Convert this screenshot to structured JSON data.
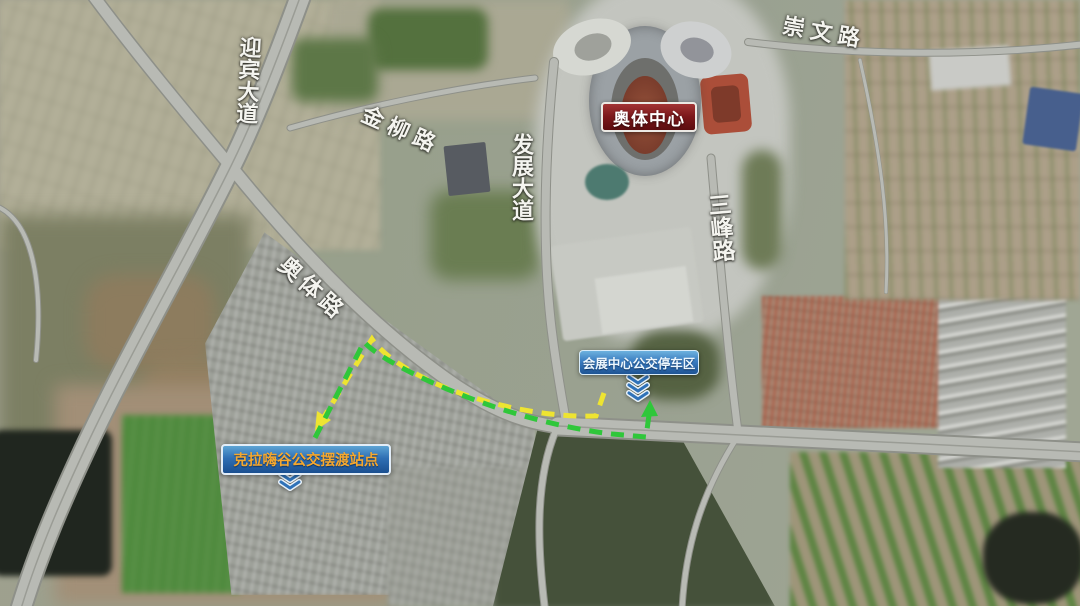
{
  "map": {
    "type": "satellite-map",
    "road_labels": {
      "yingbin_avenue": "迎宾大道",
      "jinliu_road": "金柳路",
      "fazhan_avenue": "发展大道",
      "chongwen_road": "崇文路",
      "sanfeng_road": "三峰路",
      "aoti_road": "奥体路"
    },
    "poi_labels": {
      "stadium": "奥体中心",
      "bus_parking": "会展中心公交停车区",
      "shuttle_station": "克拉嗨谷公交摆渡站点"
    },
    "routes": [
      {
        "id": "yellow-route",
        "color": "#eee431",
        "line_style": "dashed",
        "arrow_points_to": "shuttle_station"
      },
      {
        "id": "green-route",
        "color": "#2fc73a",
        "line_style": "dashed",
        "arrow_points_to": "bus_parking"
      }
    ],
    "icons": {
      "bus_parking_marker": "chevron-down-icon",
      "shuttle_station_marker": "chevron-down-icon"
    },
    "colors": {
      "stadium_label_bg": "#7c181b",
      "blue_label_bg": "#2f6fb4",
      "shuttle_label_text": "#f6a82e",
      "road_label_text": "#f4f4ef",
      "chevron_blue": "#2f72b8"
    }
  }
}
